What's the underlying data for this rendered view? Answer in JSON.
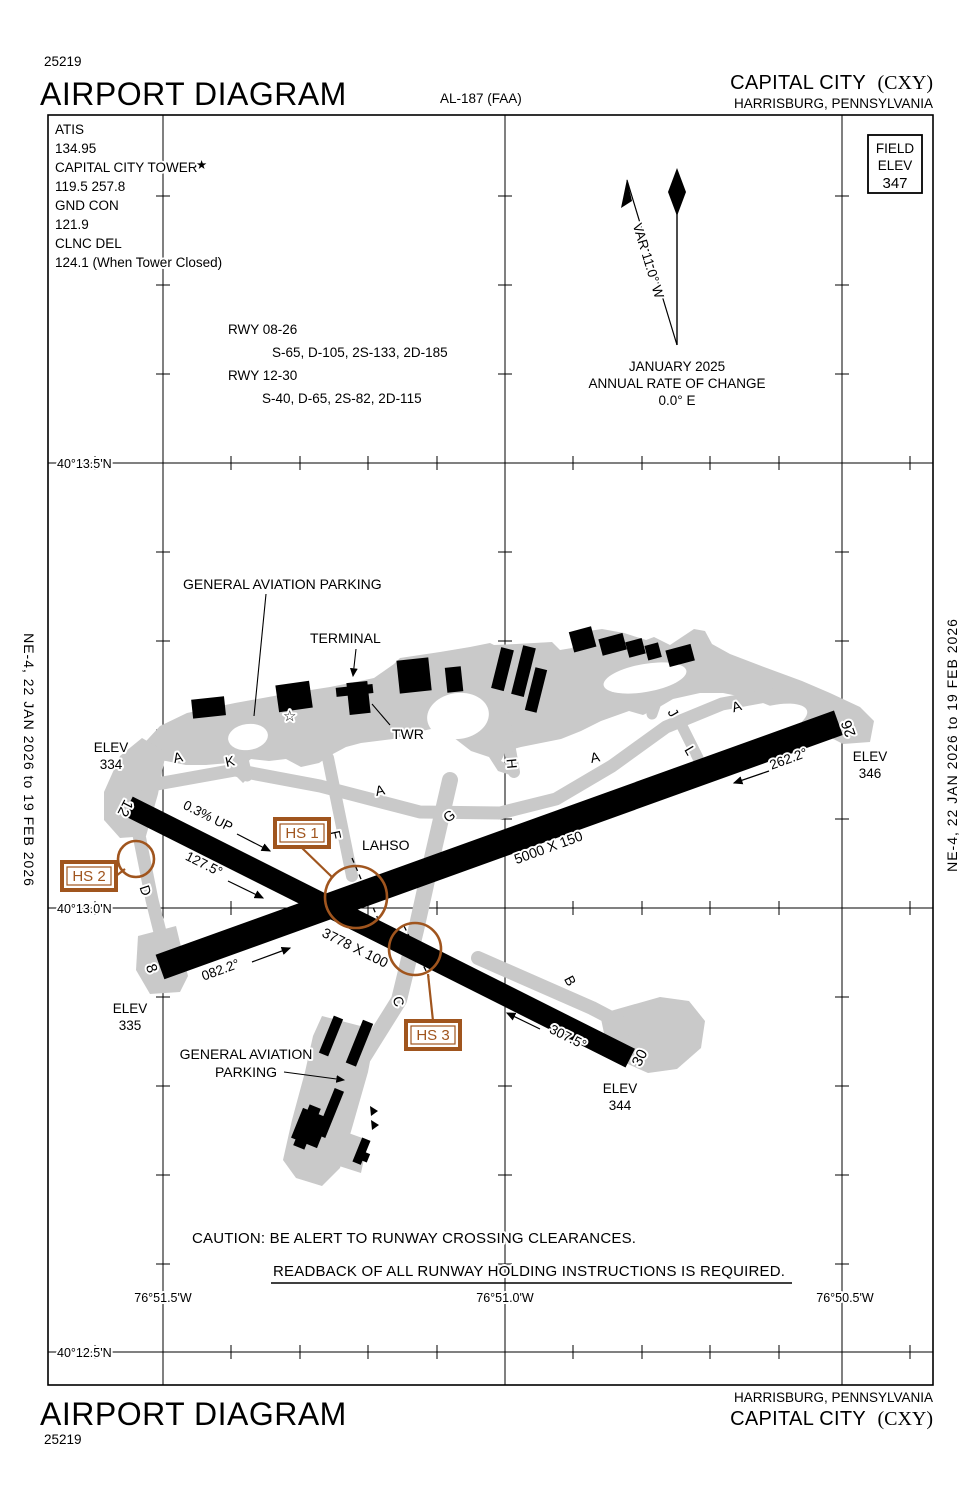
{
  "header": {
    "page_code": "25219",
    "title": "AIRPORT DIAGRAM",
    "chart_id": "AL-187 (FAA)",
    "airport": "CAPITAL CITY",
    "code": "(CXY)",
    "city": "HARRISBURG, PENNSYLVANIA"
  },
  "comm": {
    "atis_l": "ATIS",
    "atis_f": "134.95",
    "twr_l": "CAPITAL CITY TOWER",
    "twr_f": "119.5  257.8",
    "gnd_l": "GND CON",
    "gnd_f": "121.9",
    "clnc_l": "CLNC DEL",
    "clnc_f": "124.1 (When Tower Closed)"
  },
  "rwy_info": {
    "r1": "RWY  08-26",
    "r1s": "S-65, D-105, 2S-133, 2D-185",
    "r2": "RWY 12-30",
    "r2s": "S-40, D-65, 2S-82, 2D-115"
  },
  "variation": {
    "label": "VAR 11.0° W",
    "month": "JANUARY 2025",
    "rate_l": "ANNUAL RATE OF CHANGE",
    "rate_v": "0.0° E"
  },
  "field_elev": {
    "l1": "FIELD",
    "l2": "ELEV",
    "v": "347"
  },
  "margin": {
    "note": "NE-4,  22 JAN 2026  to  19 FEB 2026"
  },
  "grid": {
    "lat1": "40°13.5'N",
    "lat2": "40°13.0'N",
    "lat3": "40°12.5'N",
    "lon1": "76°51.5'W",
    "lon2": "76°51.0'W",
    "lon3": "76°50.5'W"
  },
  "rwy": {
    "n12": "12",
    "n30": "30",
    "n8": "8",
    "n26": "26",
    "d0826": "5000 X 150",
    "d1230": "3778 X 100",
    "h08": "082.2°",
    "h26": "262.2°",
    "h12": "127.5°",
    "h30": "307.5°",
    "slope": "0.3% UP",
    "lahso": "LAHSO"
  },
  "elev": {
    "label": "ELEV",
    "e12": "334",
    "e8": "335",
    "e26": "346",
    "e30": "344"
  },
  "tw": {
    "A": "A",
    "B": "B",
    "C": "C",
    "D": "D",
    "F": "F",
    "G": "G",
    "H": "H",
    "J": "J",
    "K": "K",
    "L": "L"
  },
  "labels": {
    "ga_top": "GENERAL AVIATION PARKING",
    "terminal": "TERMINAL",
    "twr": "TWR",
    "ga1": "GENERAL AVIATION",
    "ga2": "PARKING"
  },
  "hs": {
    "h1": "HS 1",
    "h2": "HS 2",
    "h3": "HS 3"
  },
  "caution": {
    "l1": "CAUTION: BE ALERT TO RUNWAY CROSSING CLEARANCES.",
    "l2": "READBACK OF ALL RUNWAY HOLDING INSTRUCTIONS IS REQUIRED."
  },
  "icons": {
    "beacon": "☆",
    "tower_star": "★"
  },
  "colors": {
    "hotspot": "#A0551E",
    "apron": "#C9C9C9",
    "ink": "#000000"
  }
}
